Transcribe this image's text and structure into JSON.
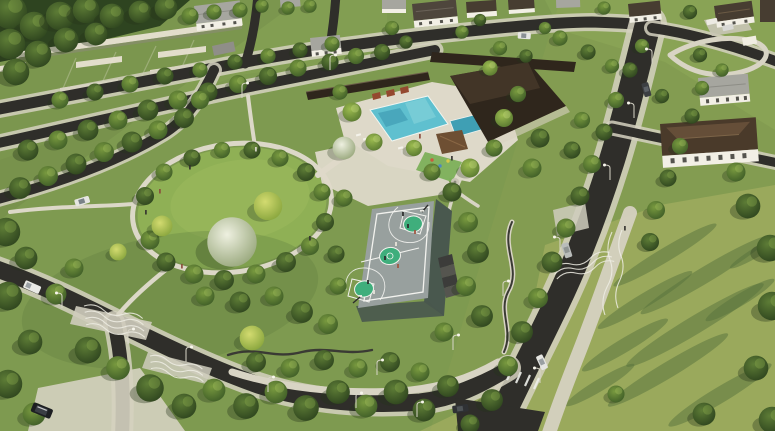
{
  "scene": {
    "type": "architectural-aerial-rendering",
    "subject": "Residential community masterplan park",
    "lighting": "warm afternoon sun with long tree shadows",
    "features": {
      "central_lawn": "central oval event lawn with walking loop",
      "basketball_court": "grey court with green center circle and keys, players, bleachers",
      "swimming_pool": "resort pool with lap lanes, deck and loungers",
      "clubhouse": "dark-roof clubhouse and entry pavilion",
      "gazebo_playground": "gazebo, play area and carousel",
      "perimeter_wall": "beige lot walls along top-left streets",
      "streets": "tree-lined asphalt streets with sidewalks, crossings and cars",
      "open_field": "large lawn with diagonal tree shadows",
      "houses": "two-storey white houses with grey and brown roofs"
    }
  },
  "palette": {
    "grass_base": "#7e9a50",
    "grass_park": "#8fb055",
    "grass_field": "#96a75c",
    "grass_shadow": "#55713c",
    "road_asphalt": "#2f2e2a",
    "sidewalk": "#d5d1c0",
    "path_light": "#dcd8c8",
    "deck": "#ded9c9",
    "wall_light": "#e2ddcb",
    "pool_water": "#5fc0cf",
    "pool_water_deep": "#3f9fb4",
    "roof_dark": "#2f261c",
    "roof_brown": "#4a3a2a",
    "roof_gray": "#a6a69f",
    "house_wall": "#f2efe5",
    "court_surface": "#98a09e",
    "court_green": "#3fae7c",
    "court_line": "#f2f2ee",
    "court_wall": "#49584e",
    "gazebo_roof": "#6e4f33",
    "car_white": "#e9e9e5",
    "car_black": "#1d1f22"
  }
}
